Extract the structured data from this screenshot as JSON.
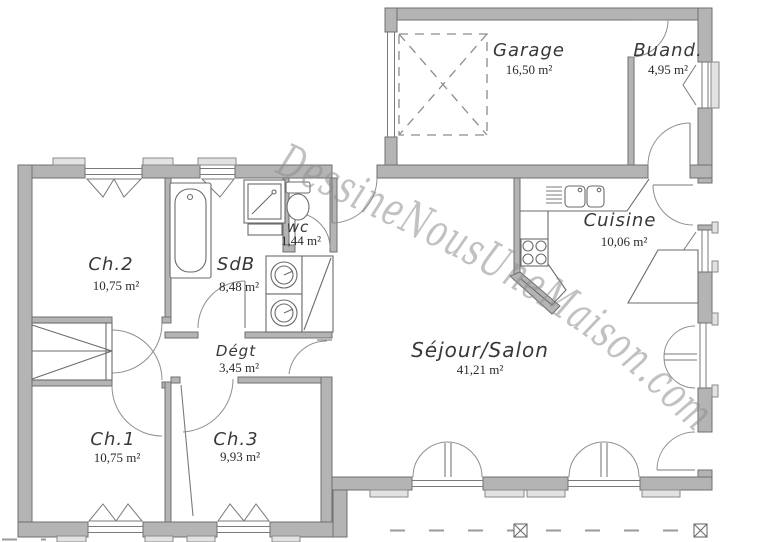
{
  "watermark": "DessineNousUneMaison.com",
  "rooms": {
    "garage": {
      "name": "Garage",
      "area": "16,50 m²"
    },
    "buanderie": {
      "name": "Buand.",
      "area": "4,95 m²"
    },
    "cuisine": {
      "name": "Cuisine",
      "area": "10,06 m²"
    },
    "wc": {
      "name": "wc",
      "area": "1,44 m²"
    },
    "sdb": {
      "name": "SdB",
      "area": "8,48 m²"
    },
    "ch2": {
      "name": "Ch.2",
      "area": "10,75 m²"
    },
    "degagement": {
      "name": "Dégt",
      "area": "3,45 m²"
    },
    "sejour": {
      "name": "Séjour/Salon",
      "area": "41,21 m²"
    },
    "ch1": {
      "name": "Ch.1",
      "area": "10,75 m²"
    },
    "ch3": {
      "name": "Ch.3",
      "area": "9,93 m²"
    }
  },
  "colors": {
    "wall_fill": "#b4b4b4",
    "wall_stroke": "#6f6f6f",
    "fixture_line": "#6b6b6b",
    "door_arc": "#8f8f8f",
    "watermark": "#8f8f8f",
    "background": "#ffffff",
    "label_text": "#383838"
  }
}
